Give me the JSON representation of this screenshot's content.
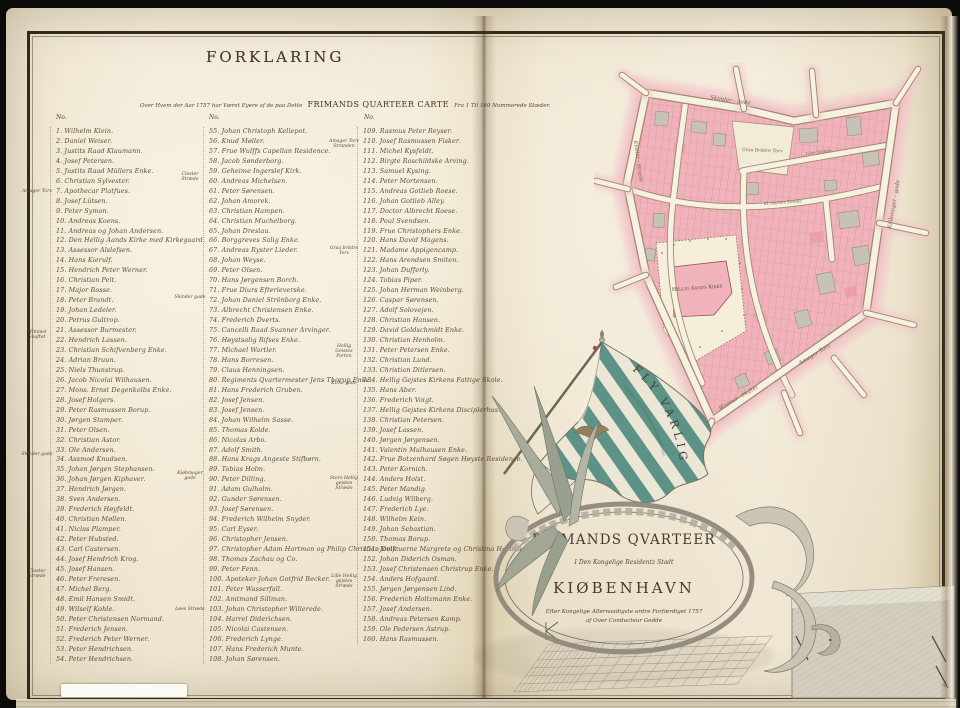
{
  "page_left": {
    "heading": "FORKLARING",
    "subtitle_script_1": "Over Hvem der Aar 1757 har Været Eyere af de paa Dette",
    "subtitle_caps": "FRIMANDS QUARTEER CARTE",
    "subtitle_script_2": "Fra 1 Til 160 Nummerede Stæder.",
    "col_header": "No.",
    "columns": [
      {
        "entries": [
          "1. Wilhelm Klein.",
          "2. Daniel Weiser.",
          "3. Justits Raad Klaumann.",
          "4. Josef Petersen.",
          "5. Justits Raad Müllers Enke.",
          "6. Christian Sylvester.",
          "7. Apothecar Platfues.",
          "8. Josef Lütsen.",
          "9. Peter Symon.",
          "10. Andreas Koens.",
          "11. Andreas og Johan Andersen.",
          "12. Den Hellig Aands Kirke med Kirkegaard.",
          "13. Assessor Alslefsen.",
          "14. Hans Kierulf.",
          "15. Hendrich Peter Werner.",
          "16. Christian Pelt.",
          "17. Major Rosse.",
          "18. Peter Brandt.",
          "19. Johan Ledeler.",
          "20. Petrus Gultrop.",
          "21. Assessor Burmester.",
          "22. Hendrich Lassen.",
          "23. Christian Schifvenberg Enke.",
          "24. Adrian Bruun.",
          "25. Niels Thunstrup.",
          "26. Jacob Nicolai Wilhausen.",
          "27. Mons. Ernst Degenkolbs Enke.",
          "28. Josef Holgers.",
          "29. Peter Rasmussen Borup.",
          "30. Jørgen Stamper.",
          "31. Peter Olsen.",
          "32. Christian Astor.",
          "33. Ole Andersen.",
          "34. Assmod Knudsen.",
          "35. Johan Jørgen Stephansen.",
          "36. Johan Jørgen Kiphaver.",
          "37. Hendrich Jørgen.",
          "38. Sven Andersen.",
          "39. Frederich Høyfeldt.",
          "40. Christian Møllen.",
          "41. Niclas Plamper.",
          "42. Peter Hubsted.",
          "43. Carl Castersen.",
          "44. Josef Hendrich Krog.",
          "45. Josef Hansen.",
          "46. Peter Freresen.",
          "47. Michel Berg.",
          "48. Emil Hansen Smidt.",
          "49. Wilself Kohle.",
          "50. Peter Christensen Normand.",
          "51. Frederich Jensen.",
          "52. Frederich Peter Werner.",
          "53. Peter Hendrichsen.",
          "54. Peter Hendrichsen."
        ]
      },
      {
        "entries": [
          "55. Johan Christoph Kellepot.",
          "56. Knud Møller.",
          "57. Frue Wulffs Capellan Residence.",
          "58. Jacob Sønderborg.",
          "59. Geheime Ingerslef Kirk.",
          "60. Andreas Michelsen.",
          "61. Peter Sørensen.",
          "62. Johan Amorek.",
          "63. Christian Hampen.",
          "64. Christian Muchelborg.",
          "65. Johan Dreslau.",
          "66. Borggreves Salig Enke.",
          "67. Andreas Ryster Lieder.",
          "68. Johan Weyse.",
          "69. Peter Olsen.",
          "70. Hans Jørgensen Borch.",
          "71. Frue Diurs Efterleverske.",
          "72. Johan Daniel Strönborg Enke.",
          "73. Albrecht Christensen Enke.",
          "74. Frederich Dverts.",
          "75. Cancelli Raad Svanner Arvinger.",
          "76. Høystsalig Rifses Enke.",
          "77. Michael Wartler.",
          "78. Hans Borresen.",
          "79. Claus Henningsen.",
          "80. Regiments Qvartermester Jens Thorup Enke.",
          "81. Hans Frederich Gruben.",
          "82. Josef Jensen.",
          "83. Josef Jensen.",
          "84. Johan Wilhelm Sasse.",
          "85. Thomas Kolde.",
          "86. Nicolas Arbo.",
          "87. Adolf Smith.",
          "88. Hans Krags Angeste Stifbørn.",
          "89. Tobias Holm.",
          "90. Peter Dilling.",
          "91. Adam Gulholm.",
          "92. Gunder Sørensen.",
          "93. Josef Sørensen.",
          "94. Frederich Wilhelm Snyder.",
          "95. Carl Eyser.",
          "96. Christopher Jensen.",
          "97. Christopher Adam Hartman og Philip Christian Delk.",
          "98. Thomas Zachau og Co.",
          "99. Peter Fenn.",
          "100. Apoteker Johan Gotfrid Becker.",
          "101. Peter Wasserfall.",
          "102. Amtmand Sillman.",
          "103. Johan Christopher Willerede.",
          "104. Harrel Diderichsen.",
          "105. Nicolai Castensen.",
          "106. Frederich Lynge.",
          "107. Hans Frederich Munte.",
          "108. Johan Sørensen."
        ]
      },
      {
        "entries": [
          "109. Rasmus Peter Reyser.",
          "110. Josef Rasmussen Fisker.",
          "111. Michel Kysfeldt.",
          "112. Birgte Roschildske Arving.",
          "113. Samuel Kysing.",
          "114. Peter Mortensen.",
          "115. Andreas Gotlieb Roese.",
          "116. Johan Gotlieb Alley.",
          "117. Doctor Albrecht Roese.",
          "118. Poul Svendsen.",
          "119. Frue Christophers Enke.",
          "120. Hans David Magens.",
          "121. Madame Appigencamp.",
          "122. Hans Arendsen Smiten.",
          "123. Johan Dufferly.",
          "124. Tobias Piper.",
          "125. Johan Herman Weinberg.",
          "126. Caspar Sørensen.",
          "127. Adolf Solovejen.",
          "128. Christian Hansen.",
          "129. David Goldschmidt Enke.",
          "130. Christian Henholm.",
          "131. Peter Petersen Enke.",
          "132. Christian Lund.",
          "133. Christian Ditlersen.",
          "134. Hellig Gejstes Kirkens Fattige Skole.",
          "135. Hans Aber.",
          "136. Frederich Voigt.",
          "137. Hellig Gejstes Kirkens Disciplerhus.",
          "138. Christian Petersen.",
          "139. Josef Lassen.",
          "140. Jørgen Jørgensen.",
          "141. Valentin Mulhausen Enke.",
          "142. Frue Botzenhard Søgen Høyste Residence.",
          "143. Peter Kornich.",
          "144. Anders Holst.",
          "145. Peter Mandig.",
          "146. Ludvig Wilberg.",
          "147. Frederich Lye.",
          "148. Wilhelm Kein.",
          "149. Johan Sebastian.",
          "150. Thomas Borup.",
          "151. Jomfruerne Margrete og Christina Hartman.",
          "152. Johan Diderich Osman.",
          "153. Josef Christensen Christrup Enke.",
          "154. Anders Hofgaard.",
          "155. Jørgen Jørgensen Lind.",
          "156. Frederich Holtzmann Enke.",
          "157. Josef Andersen.",
          "158. Andreas Petersen Kamp.",
          "159. Ole Pedersen Astrup.",
          "160. Hans Rasmussen."
        ]
      }
    ],
    "margin_labels_col1": [
      "Amager Torv",
      "Wimmel Skaftet",
      "Skinder gade",
      "Closter Stræde"
    ],
    "margin_labels_col2": [
      "Closter Stræde",
      "Skinder gade",
      "Kiøbmager gade",
      "Løve Stræde"
    ],
    "margin_labels_col3": [
      "Amager Torv Stranden",
      "Graa brödre Torv",
      "Hellig Geistes Porten",
      "Kirke gade",
      "Store Hellig gejstes Stræde",
      "Lille Hellig gejstes Stræde"
    ]
  },
  "map": {
    "street_labels": {
      "skindergade": "Skinder - gade",
      "kiobmagergade": "Kiöbmager - gade",
      "amagertorv": "Amager Torv",
      "vimmelskaftet": "Wimmel - Skaftet",
      "klosterstraede": "Kloster - Stræde",
      "lovstraede": "Löve Stræde",
      "helliggejststraede": "St. Gejstes Stræde",
      "graabrodretorv": "Graa Brödre Torv",
      "church": "Hellig Aands Kirke"
    },
    "colors": {
      "parcel_pink": "#f0b3bb",
      "parcel_gray": "#c7c3b4",
      "halo_pink": "#f3c3ca",
      "street_white": "#f6f1e2"
    }
  },
  "cartouche": {
    "motto": "FLY VARLIG",
    "title": "FRIMANDS QVARTEER",
    "sub1": "I Den Kongelige Residentz Stadt",
    "city": "KIØBENHAVN",
    "sub2": "Efter Kongelige Allernaadigste ordre Forfærdiget 1757",
    "sub3": "af Over Conducteur Gedde",
    "flag_green": "#5d9386"
  },
  "corner_mark": "4"
}
